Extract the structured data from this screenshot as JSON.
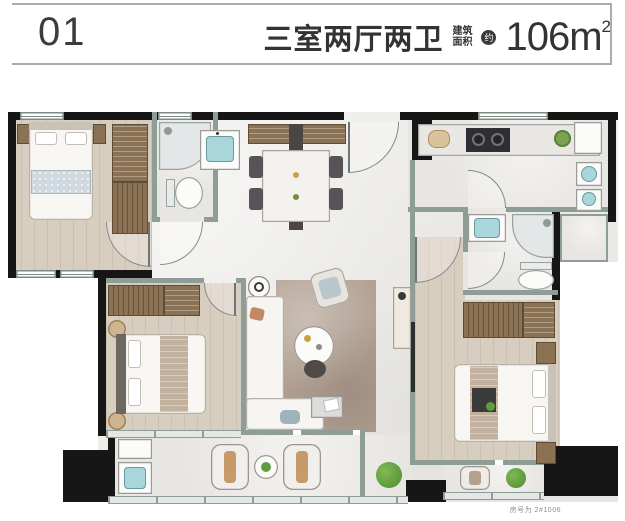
{
  "header": {
    "unit_number": "01",
    "title": "三室两厅两卫",
    "area_label_line1": "建筑",
    "area_label_line2": "面积",
    "approx_badge": "约",
    "area_value": "106",
    "area_unit": "m",
    "area_sup": "2"
  },
  "footer": {
    "unit_note": "房号为 2#1006"
  },
  "colors": {
    "wall_black": "#161616",
    "wall_sage": "#8f9d99",
    "floor_wood": "#d8cec0",
    "floor_tile": "#ecebe7",
    "rug_taupe": "#b3a294",
    "cabinet_brown": "#8b7254",
    "fixture_blue": "#a9d6db",
    "text_ink": "#3a3a3a",
    "plant_green": "#5e9e3e"
  }
}
